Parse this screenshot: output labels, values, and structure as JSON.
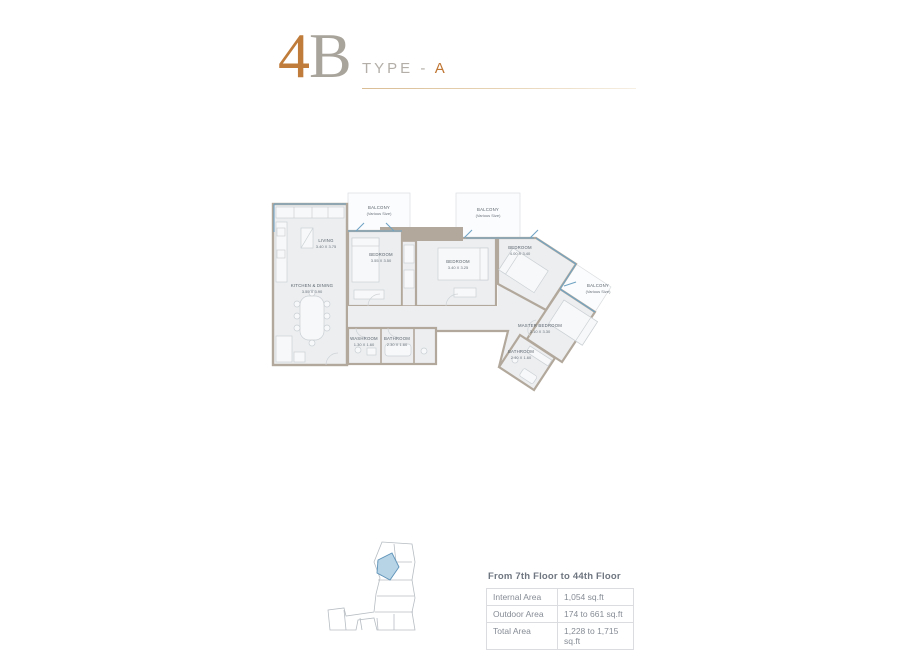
{
  "header": {
    "num": "4",
    "letter": "B",
    "type_prefix": "TYPE - ",
    "type_value": "A"
  },
  "plan": {
    "rooms": {
      "living": {
        "name": "LIVING",
        "dims": "3.40 X 3.75"
      },
      "kitchen": {
        "name": "KITCHEN & DINING",
        "dims": "3.55 X 3.90"
      },
      "bedroom1": {
        "name": "BEDROOM",
        "dims": "3.55 X 3.50"
      },
      "bedroom2": {
        "name": "BEDROOM",
        "dims": "3.40 X 3.25"
      },
      "bedroom3": {
        "name": "BEDROOM",
        "dims": "4.00 X 3.40"
      },
      "master": {
        "name": "MASTER BEDROOM",
        "dims": "3.10 X 3.30"
      },
      "bathroom_main": {
        "name": "BATHROOM",
        "dims": "2.40 X 1.60"
      },
      "washroom": {
        "name": "WASHROOM",
        "dims": "1.30 X 1.60"
      },
      "bathroom2": {
        "name": "BATHROOM",
        "dims": "2.30 X 1.60"
      }
    },
    "balconies": [
      {
        "name": "BALCONY",
        "sub": "(Various Size)"
      },
      {
        "name": "BALCONY",
        "sub": "(Various Size)"
      },
      {
        "name": "BALCONY",
        "sub": "(Various Size)"
      }
    ]
  },
  "info": {
    "floors_label": "From 7th Floor to 44th Floor",
    "rows": [
      {
        "label": "Internal Area",
        "value": "1,054 sq.ft"
      },
      {
        "label": "Outdoor Area",
        "value": "174 to 661 sq.ft"
      },
      {
        "label": "Total Area",
        "value": "1,228 to 1,715 sq.ft"
      }
    ]
  },
  "colors": {
    "accent_orange": "#bf7633",
    "title_gray": "#a8a39b",
    "wall_taupe": "#b2a89b",
    "room_fill": "#eceef0",
    "glazing_blue": "#6fa3c4",
    "keyplan_highlight": "#b7d3e6",
    "table_border": "#dadce0",
    "table_text": "#868c95"
  }
}
